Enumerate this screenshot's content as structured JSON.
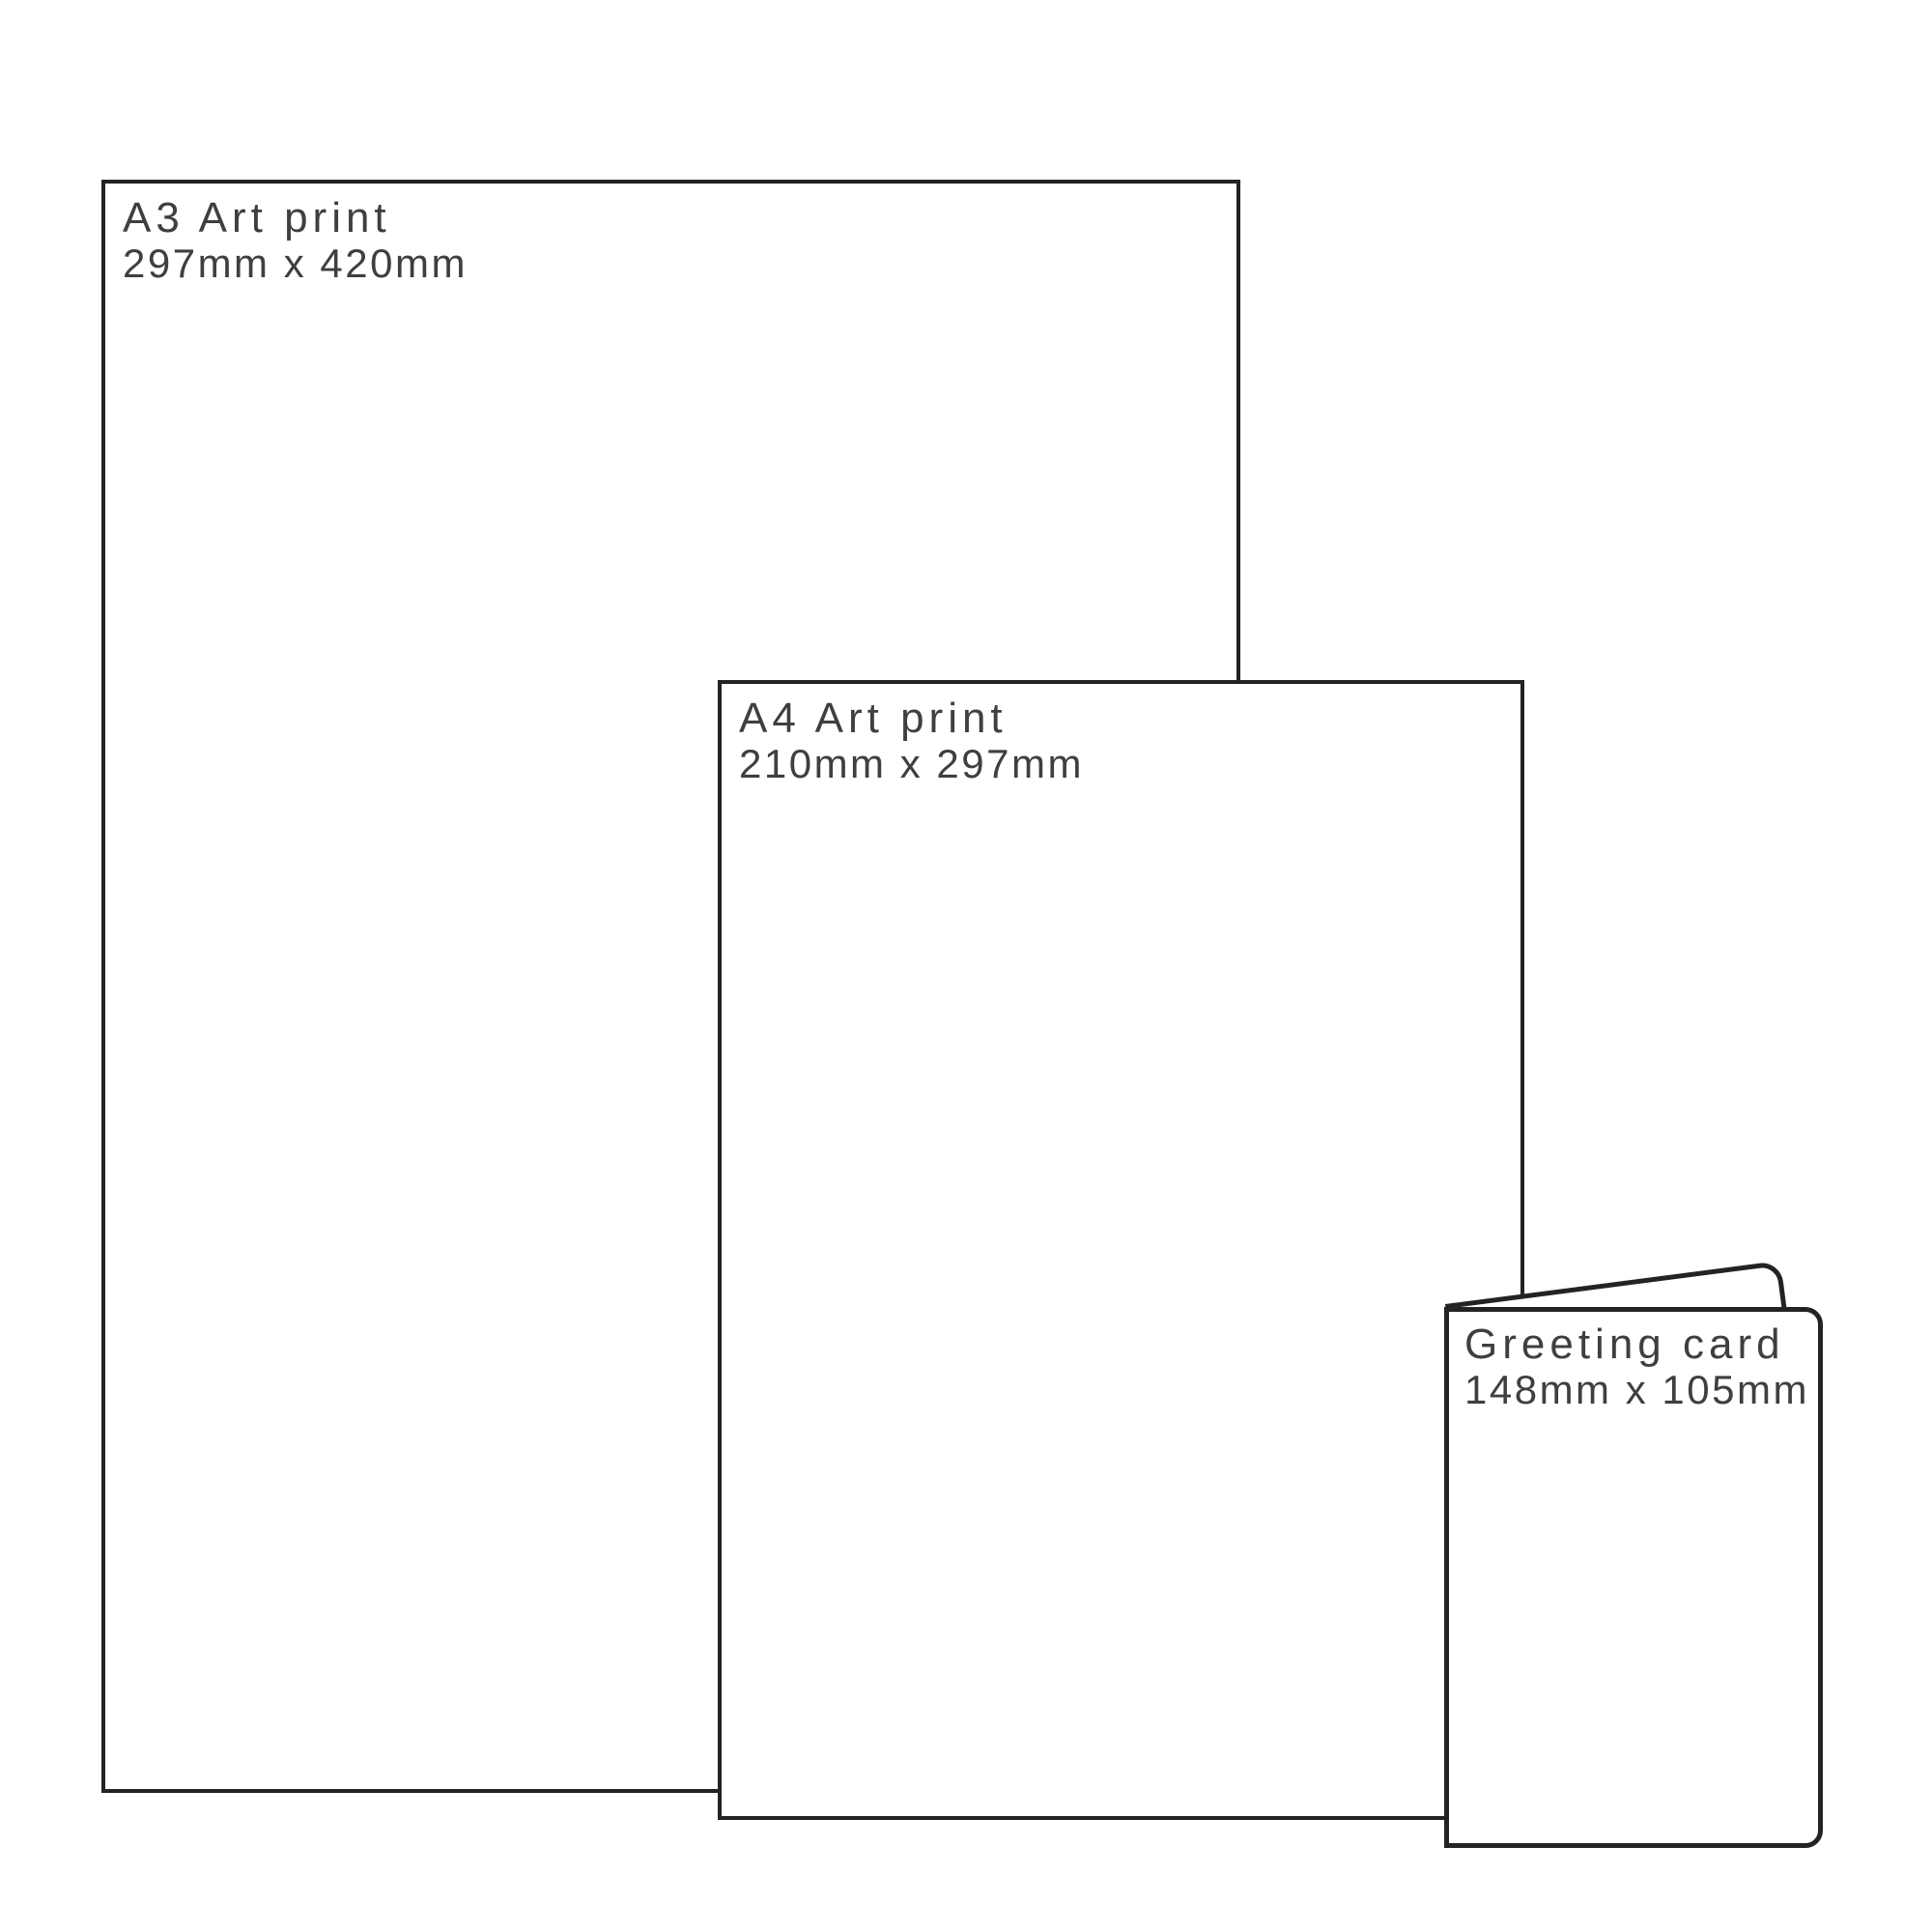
{
  "colors": {
    "outline": "#232323",
    "text": "#3f3f3f",
    "background": "#ffffff"
  },
  "sheets": [
    {
      "id": "a3",
      "title": "A3 Art print",
      "dimensions": "297mm x 420mm"
    },
    {
      "id": "a4",
      "title": "A4 Art print",
      "dimensions": "210mm x 297mm"
    },
    {
      "id": "card",
      "title": "Greeting card",
      "dimensions": "148mm x 105mm"
    }
  ]
}
